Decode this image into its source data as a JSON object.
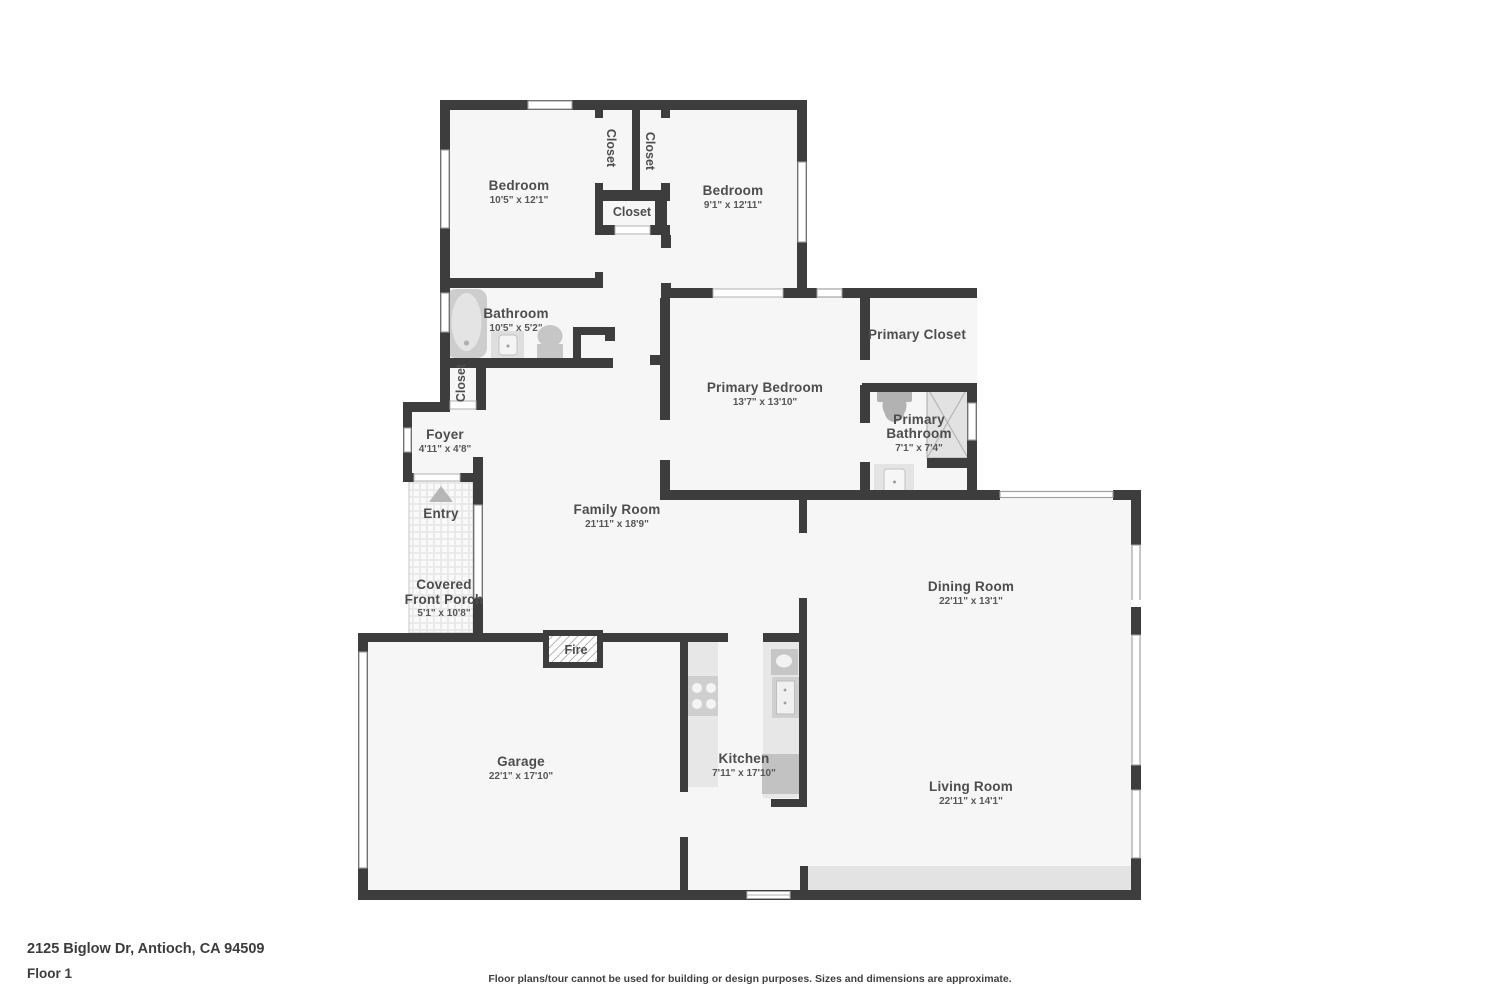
{
  "title": "Floor plan - 2125 Biglow Dr",
  "rooms": {
    "bedroom_left": {
      "name": "Bedroom",
      "dims": "10'5\" x 12'1\""
    },
    "closet_1": {
      "name": "Closet"
    },
    "closet_2": {
      "name": "Closet"
    },
    "closet_hall": {
      "name": "Closet"
    },
    "bedroom_right": {
      "name": "Bedroom",
      "dims": "9'1\" x 12'11\""
    },
    "bathroom": {
      "name": "Bathroom",
      "dims": "10'5\" x 5'2\""
    },
    "closet_foyer": {
      "name": "Closet"
    },
    "foyer": {
      "name": "Foyer",
      "dims": "4'11\" x 4'8\""
    },
    "entry": {
      "name": "Entry"
    },
    "porch": {
      "line1": "Covered",
      "line2": "Front Porch",
      "dims": "5'1\" x 10'8\""
    },
    "family_room": {
      "name": "Family Room",
      "dims": "21'11\" x 18'9\""
    },
    "primary_bedroom": {
      "name": "Primary Bedroom",
      "dims": "13'7\" x 13'10\""
    },
    "primary_closet": {
      "name": "Primary Closet"
    },
    "primary_bath": {
      "line1": "Primary",
      "line2": "Bathroom",
      "dims": "7'1\" x 7'4\""
    },
    "dining_room": {
      "name": "Dining Room",
      "dims": "22'11\" x 13'1\""
    },
    "living_room": {
      "name": "Living Room",
      "dims": "22'11\" x 14'1\""
    },
    "garage": {
      "name": "Garage",
      "dims": "22'1\" x 17'10\""
    },
    "kitchen": {
      "name": "Kitchen",
      "dims": "7'11\" x 17'10\""
    },
    "fireplace": {
      "name": "Fire"
    }
  },
  "footer": {
    "address": "2125 Biglow Dr, Antioch, CA 94509",
    "floor_label": "Floor 1",
    "disclaimer": "Floor plans/tour cannot be used for building or design purposes. Sizes and dimensions are approximate."
  },
  "colors": {
    "wall": "#3d3d3d",
    "floor": "#f6f6f6",
    "fixture": "#c9c9c9",
    "label": "#4d4d4d",
    "hearth": "#e3e3e3"
  }
}
